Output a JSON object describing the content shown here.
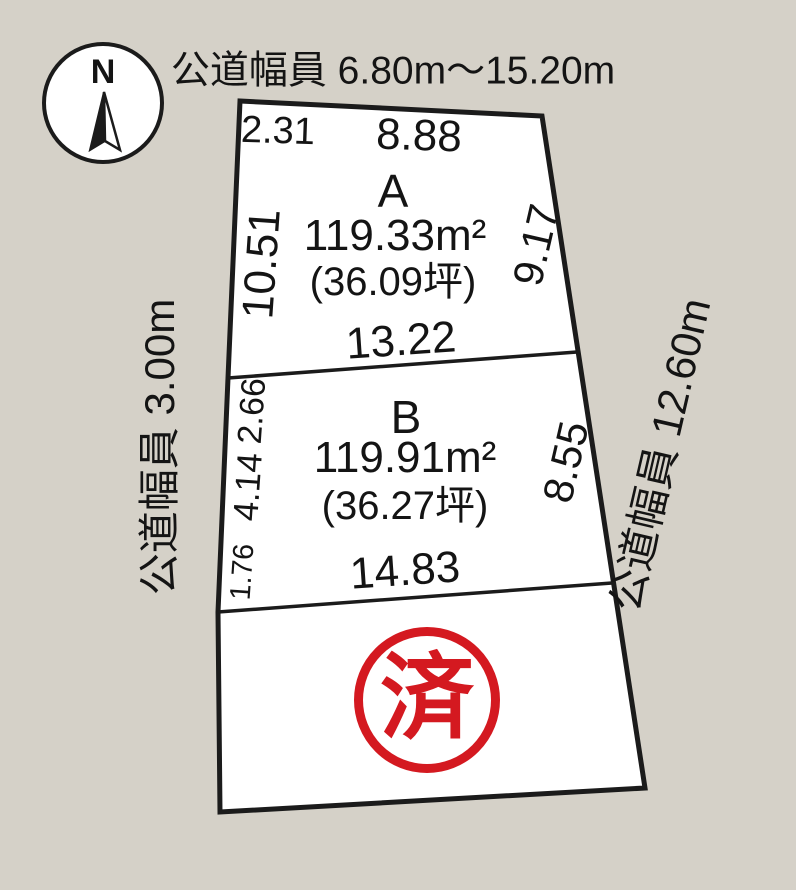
{
  "colors": {
    "background": "#d5d1c8",
    "parcel_fill": "#ffffff",
    "line": "#1b1b1b",
    "text": "#141414",
    "stamp_red": "#d41920"
  },
  "title": {
    "road_width_top": "公道幅員 6.80m～15.20m"
  },
  "compass": {
    "north_label": "N"
  },
  "roads": {
    "left": "公道幅員 3.00m",
    "right": "公道幅員 12.60m"
  },
  "plots": [
    {
      "name": "A",
      "area_m2": "119.33m²",
      "area_tsubo": "(36.09坪)",
      "dims": {
        "top_left": "2.31",
        "top": "8.88",
        "left": "10.51",
        "right": "9.17",
        "bottom": "13.22"
      }
    },
    {
      "name": "B",
      "area_m2": "119.91m²",
      "area_tsubo": "(36.27坪)",
      "dims": {
        "left_upper": "2.66",
        "left_middle": "4.14",
        "left_lower": "1.76",
        "right": "8.55",
        "bottom": "14.83"
      }
    },
    {
      "name": "C",
      "status_stamp": "済"
    }
  ]
}
